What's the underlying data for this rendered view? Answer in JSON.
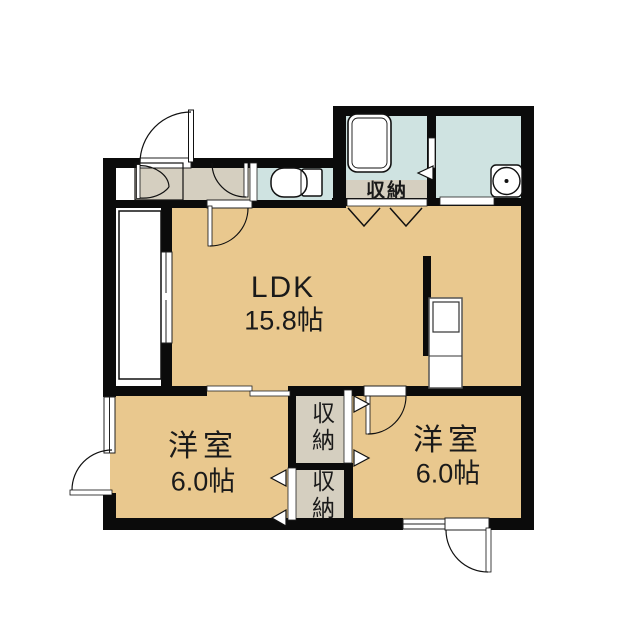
{
  "plan_title": "apartment-floor-plan",
  "rooms": {
    "ldk": {
      "label": "LDK",
      "area": "15.8帖"
    },
    "bedroom_left": {
      "label": "洋室",
      "area": "6.0帖"
    },
    "bedroom_right": {
      "label": "洋室",
      "area": "6.0帖"
    }
  },
  "storage": {
    "hall_label": "収納",
    "upper_closet_label": "収納",
    "lower_closet_label": "収納"
  },
  "fixtures": {
    "bathtub": "bathtub-icon",
    "toilet": "toilet-icon",
    "washing_machine_pan": "washing-machine-pan-icon",
    "kitchen_counter": "kitchen-counter-sink-icon"
  },
  "colors": {
    "room_floor": "#e9c88e",
    "wet_area": "#cfe3e1",
    "hall_floor": "#d5cfc0",
    "wall": "#0b0b0b",
    "text": "#1a1a1a"
  }
}
